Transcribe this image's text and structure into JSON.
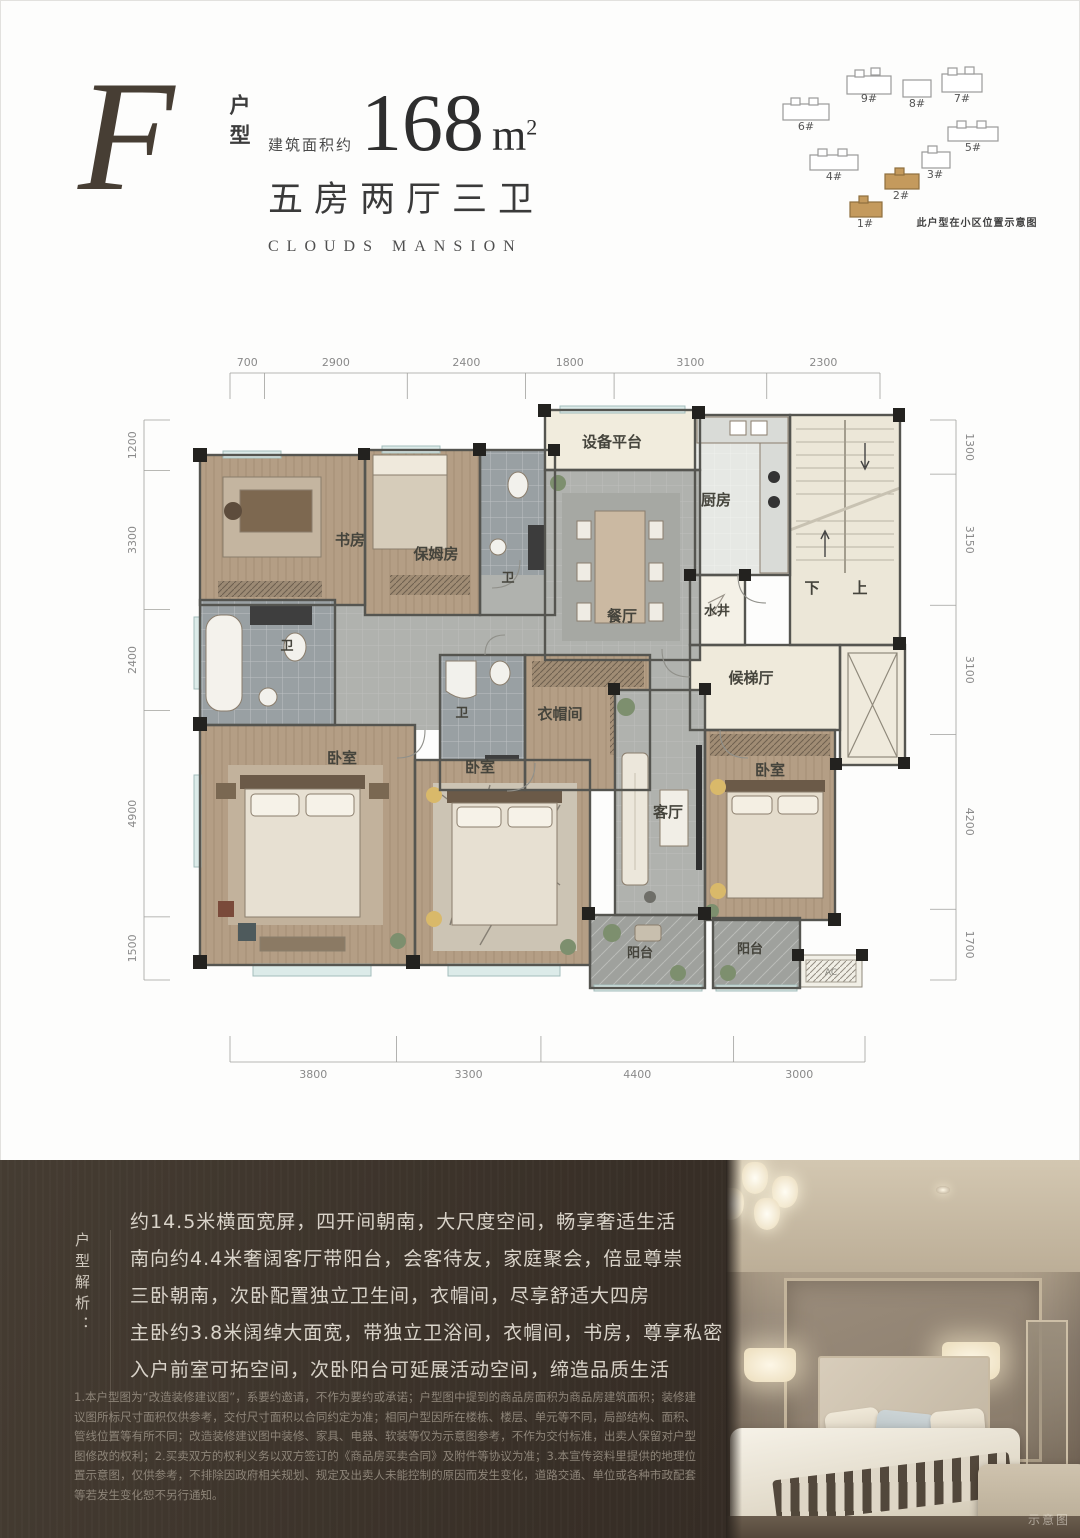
{
  "header": {
    "type_letter": "F",
    "type_label": "户型",
    "area_prefix": "建筑面积约",
    "area_value": "168",
    "area_unit": "m",
    "area_sup": "2",
    "rooms_summary": "五房两厅三卫",
    "brand": "CLOUDS MANSION"
  },
  "siteplan": {
    "caption": "此户型在小区位置示意图",
    "buildings": [
      {
        "id": "9#",
        "highlight": false
      },
      {
        "id": "8#",
        "highlight": false
      },
      {
        "id": "7#",
        "highlight": false
      },
      {
        "id": "6#",
        "highlight": false
      },
      {
        "id": "5#",
        "highlight": false
      },
      {
        "id": "4#",
        "highlight": false
      },
      {
        "id": "3#",
        "highlight": false
      },
      {
        "id": "2#",
        "highlight": true
      },
      {
        "id": "1#",
        "highlight": true
      }
    ]
  },
  "floorplan": {
    "dims": {
      "top": [
        700,
        2900,
        2400,
        1800,
        3100,
        2300
      ],
      "bottom": [
        3800,
        3300,
        4400,
        3000
      ],
      "left": [
        1200,
        3300,
        2400,
        4900,
        1500
      ],
      "right": [
        1300,
        3150,
        3100,
        4200,
        1700
      ]
    },
    "room_labels": [
      {
        "name": "equipment-platform",
        "label": "设备平台"
      },
      {
        "name": "kitchen",
        "label": "厨房"
      },
      {
        "name": "dining-room",
        "label": "餐厅"
      },
      {
        "name": "water-well",
        "label": "水井"
      },
      {
        "name": "stairs-down",
        "label": "下"
      },
      {
        "name": "stairs-up",
        "label": "上"
      },
      {
        "name": "elevator-hall",
        "label": "候梯厅"
      },
      {
        "name": "study",
        "label": "书房"
      },
      {
        "name": "nanny-room",
        "label": "保姆房"
      },
      {
        "name": "bath-top",
        "label": "卫"
      },
      {
        "name": "bath-left",
        "label": "卫"
      },
      {
        "name": "bath-middle",
        "label": "卫"
      },
      {
        "name": "cloakroom",
        "label": "衣帽间"
      },
      {
        "name": "bedroom-master",
        "label": "卧室"
      },
      {
        "name": "bedroom-second",
        "label": "卧室"
      },
      {
        "name": "living-room",
        "label": "客厅"
      },
      {
        "name": "bedroom-right",
        "label": "卧室"
      },
      {
        "name": "balcony-1",
        "label": "阳台"
      },
      {
        "name": "balcony-2",
        "label": "阳台"
      },
      {
        "name": "ac-platform",
        "label": "AC"
      }
    ]
  },
  "analysis": {
    "title": "户型解析：",
    "lines": [
      "约14.5米横面宽屏，四开间朝南，大尺度空间，畅享奢适生活",
      "南向约4.4米奢阔客厅带阳台，会客待友，家庭聚会，倍显尊崇",
      "三卧朝南，次卧配置独立卫生间，衣帽间，尽享舒适大四房",
      "主卧约3.8米阔绰大面宽，带独立卫浴间，衣帽间，书房，尊享私密",
      "入户前室可拓空间，次卧阳台可延展活动空间，缔造品质生活"
    ]
  },
  "disclaimer": "1.本户型图为“改造装修建议图”，系要约邀请，不作为要约或承诺；户型图中提到的商品房面积为商品房建筑面积；装修建议图所标尺寸面积仅供参考，交付尺寸面积以合同约定为准；相同户型因所在楼栋、楼层、单元等不同，局部结构、面积、管线位置等有所不同；改造装修建议图中装修、家具、电器、软装等仅为示意图参考，不作为交付标准，出卖人保留对户型图修改的权利；2.买卖双方的权利义务以双方签订的《商品房买卖合同》及附件等协议为准；3.本宣传资料里提供的地理位置示意图，仅供参考，不排除因政府相关规划、规定及出卖人未能控制的原因而发生变化，道路交通、单位或各种市政配套等若发生变化恕不另行通知。",
  "photo": {
    "watermark": "示意图"
  },
  "colors": {
    "accent_tan": "#c49a5d",
    "panel_brown": "#382f27",
    "wood_floor": "#b49e85",
    "gray_tile": "#b2b4b0",
    "bath_tile": "#99a0a3",
    "cream": "#ece7d8"
  }
}
